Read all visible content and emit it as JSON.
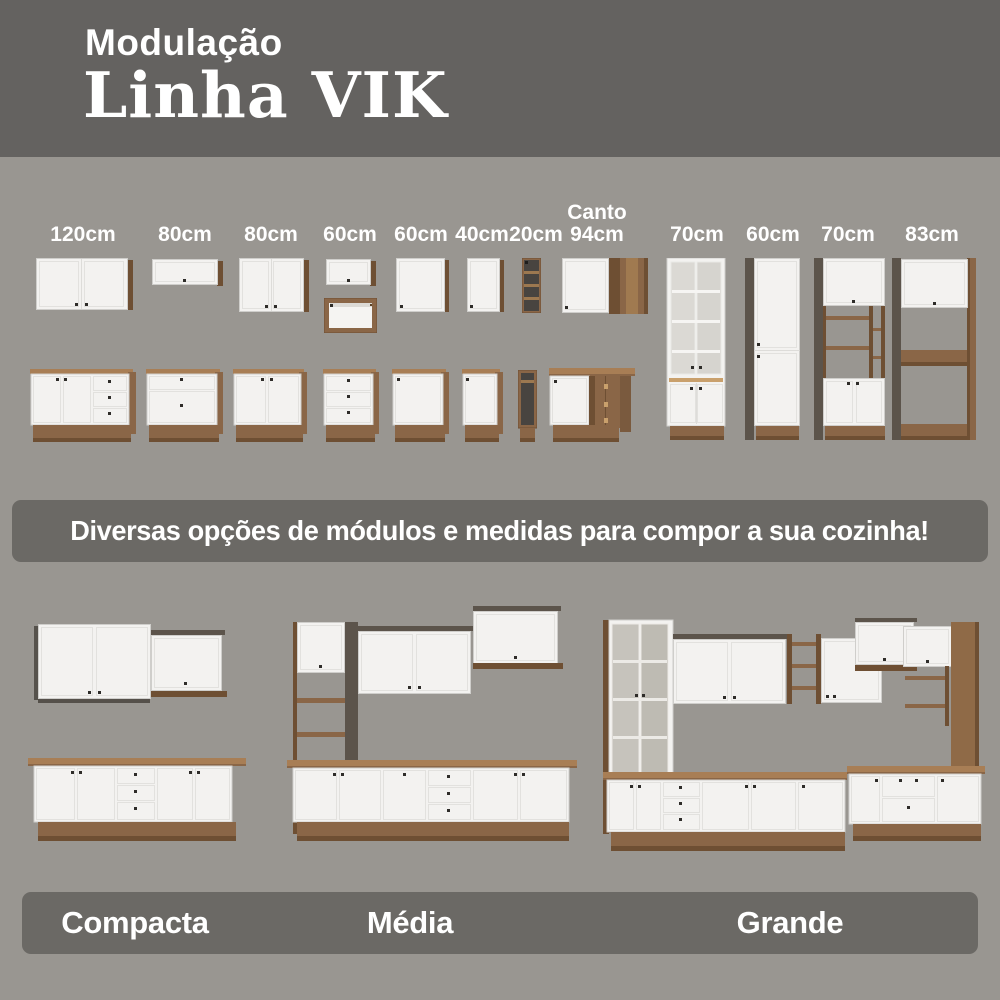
{
  "header": {
    "kicker": "Modulação",
    "title": "Linha VIK"
  },
  "modules": {
    "items": [
      {
        "label": "120cm",
        "name": "wall-and-base-120"
      },
      {
        "label": "80cm",
        "name": "wall-flip-and-base-80"
      },
      {
        "label": "80cm",
        "name": "wall-and-base-80"
      },
      {
        "label": "60cm",
        "name": "wall-flip-niche-and-drawers-60"
      },
      {
        "label": "60cm",
        "name": "wall-and-base-60"
      },
      {
        "label": "40cm",
        "name": "wall-and-base-40"
      },
      {
        "label": "20cm",
        "name": "open-shelf-20"
      },
      {
        "label": "Canto\n94cm",
        "name": "corner-94"
      },
      {
        "label": "70cm",
        "name": "glass-tower-70"
      },
      {
        "label": "60cm",
        "name": "tall-cabinet-60"
      },
      {
        "label": "70cm",
        "name": "oven-tower-70"
      },
      {
        "label": "83cm",
        "name": "fridge-frame-83"
      }
    ]
  },
  "banner": {
    "text": "Diversas opções de módulos e medidas para compor a sua cozinha!"
  },
  "legend": {
    "items": [
      {
        "label": "Compacta"
      },
      {
        "label": "Média"
      },
      {
        "label": "Grande"
      }
    ]
  },
  "colors": {
    "background": "#999691",
    "header_band": "#646260",
    "panel": "#6b6965",
    "cabinet_white": "#f3f2f0",
    "wood_light": "#a87e55",
    "wood_mid": "#8a6647",
    "wood_dark": "#6e4f33",
    "side_dark": "#5c544b",
    "text": "#ffffff"
  }
}
